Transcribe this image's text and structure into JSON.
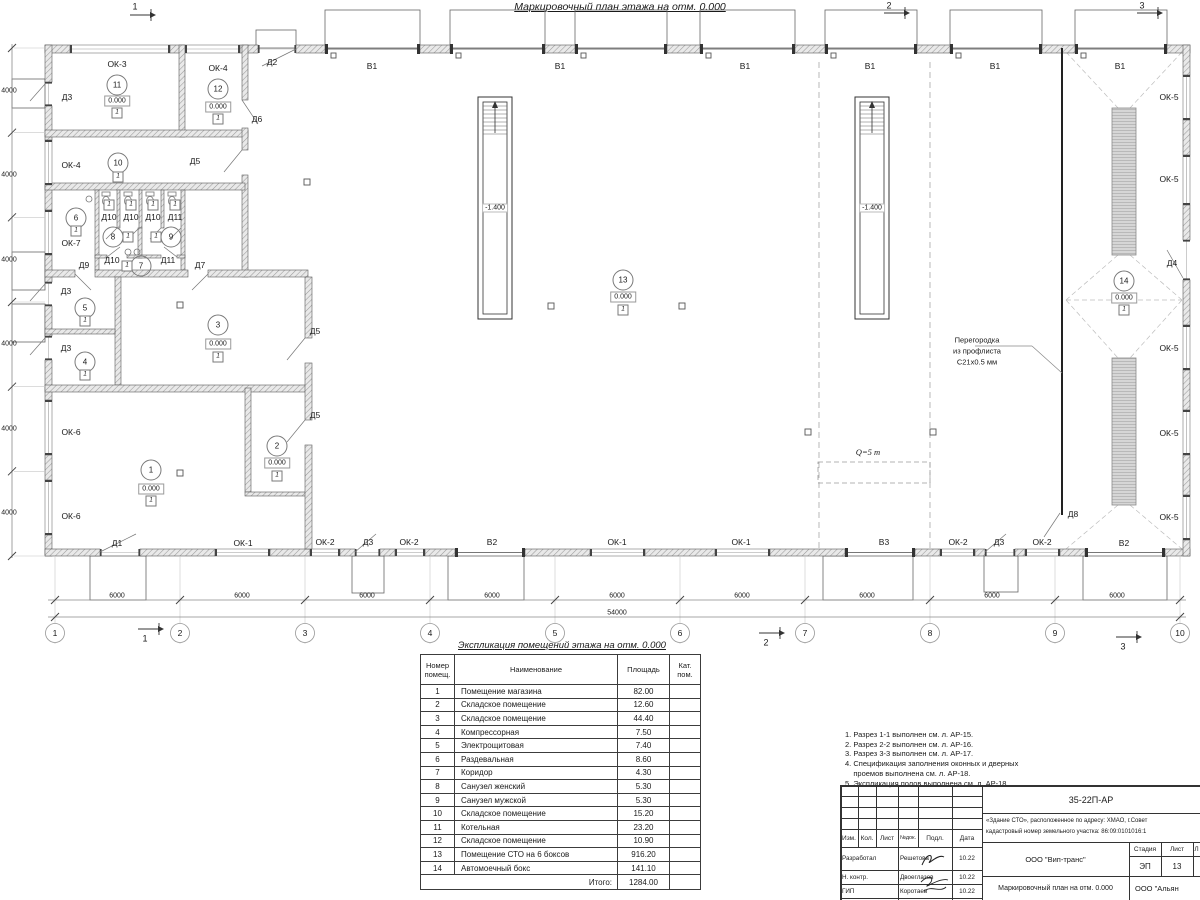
{
  "page_title": "Маркировочный план этажа на отм. 0.000",
  "plan": {
    "labels": [
      {
        "t": "Д2",
        "x": 272,
        "y": 62,
        "k": "w"
      },
      {
        "t": "В1",
        "x": 372,
        "y": 66,
        "k": "w"
      },
      {
        "t": "В1",
        "x": 560,
        "y": 66,
        "k": "w"
      },
      {
        "t": "В1",
        "x": 745,
        "y": 66,
        "k": "w"
      },
      {
        "t": "В1",
        "x": 870,
        "y": 66,
        "k": "w"
      },
      {
        "t": "В1",
        "x": 995,
        "y": 66,
        "k": "w"
      },
      {
        "t": "В1",
        "x": 1120,
        "y": 66,
        "k": "w"
      },
      {
        "t": "ОК-3",
        "x": 117,
        "y": 64,
        "k": "w"
      },
      {
        "t": "ОК-4",
        "x": 218,
        "y": 68,
        "k": "w"
      },
      {
        "t": "Д3",
        "x": 67,
        "y": 97,
        "k": "w"
      },
      {
        "t": "Д6",
        "x": 257,
        "y": 119,
        "k": "w"
      },
      {
        "t": "ОК-4",
        "x": 71,
        "y": 165,
        "k": "w"
      },
      {
        "t": "Д5",
        "x": 195,
        "y": 161,
        "k": "w"
      },
      {
        "t": "Д10",
        "x": 109,
        "y": 217,
        "k": "w"
      },
      {
        "t": "Д10",
        "x": 131,
        "y": 217,
        "k": "w"
      },
      {
        "t": "Д10",
        "x": 153,
        "y": 217,
        "k": "w"
      },
      {
        "t": "Д11",
        "x": 175,
        "y": 217,
        "k": "w"
      },
      {
        "t": "ОК-7",
        "x": 71,
        "y": 243,
        "k": "w"
      },
      {
        "t": "Д9",
        "x": 84,
        "y": 265,
        "k": "w"
      },
      {
        "t": "Д10",
        "x": 112,
        "y": 260,
        "k": "w"
      },
      {
        "t": "Д11",
        "x": 168,
        "y": 260,
        "k": "w"
      },
      {
        "t": "Д7",
        "x": 200,
        "y": 265,
        "k": "w"
      },
      {
        "t": "Д3",
        "x": 66,
        "y": 291,
        "k": "w"
      },
      {
        "t": "Д3",
        "x": 66,
        "y": 348,
        "k": "w"
      },
      {
        "t": "Д5",
        "x": 315,
        "y": 331,
        "k": "w"
      },
      {
        "t": "Д5",
        "x": 315,
        "y": 415,
        "k": "w"
      },
      {
        "t": "ОК-6",
        "x": 71,
        "y": 432,
        "k": "w"
      },
      {
        "t": "ОК-6",
        "x": 71,
        "y": 516,
        "k": "w"
      },
      {
        "t": "Д1",
        "x": 117,
        "y": 543,
        "k": "w"
      },
      {
        "t": "ОК-1",
        "x": 243,
        "y": 543,
        "k": "w"
      },
      {
        "t": "ОК-2",
        "x": 325,
        "y": 542,
        "k": "w"
      },
      {
        "t": "Д3",
        "x": 368,
        "y": 542,
        "k": "w"
      },
      {
        "t": "ОК-2",
        "x": 409,
        "y": 542,
        "k": "w"
      },
      {
        "t": "В2",
        "x": 492,
        "y": 542,
        "k": "w"
      },
      {
        "t": "ОК-1",
        "x": 617,
        "y": 542,
        "k": "w"
      },
      {
        "t": "ОК-1",
        "x": 741,
        "y": 542,
        "k": "w"
      },
      {
        "t": "В3",
        "x": 884,
        "y": 542,
        "k": "w"
      },
      {
        "t": "ОК-2",
        "x": 958,
        "y": 542,
        "k": "w"
      },
      {
        "t": "Д3",
        "x": 999,
        "y": 542,
        "k": "w"
      },
      {
        "t": "ОК-2",
        "x": 1042,
        "y": 542,
        "k": "w"
      },
      {
        "t": "В2",
        "x": 1124,
        "y": 543,
        "k": "w"
      },
      {
        "t": "ОК-5",
        "x": 1169,
        "y": 97,
        "k": "w"
      },
      {
        "t": "ОК-5",
        "x": 1169,
        "y": 179,
        "k": "w"
      },
      {
        "t": "Д4",
        "x": 1172,
        "y": 263,
        "k": "w"
      },
      {
        "t": "ОК-5",
        "x": 1169,
        "y": 348,
        "k": "w"
      },
      {
        "t": "ОК-5",
        "x": 1169,
        "y": 433,
        "k": "w"
      },
      {
        "t": "ОК-5",
        "x": 1169,
        "y": 517,
        "k": "w"
      },
      {
        "t": "Д8",
        "x": 1073,
        "y": 514,
        "k": "w"
      },
      {
        "t": "11",
        "x": 117,
        "y": 85,
        "k": "r"
      },
      {
        "t": "12",
        "x": 218,
        "y": 89,
        "k": "r"
      },
      {
        "t": "10",
        "x": 118,
        "y": 163,
        "k": "r"
      },
      {
        "t": "6",
        "x": 76,
        "y": 218,
        "k": "r"
      },
      {
        "t": "8",
        "x": 113,
        "y": 237,
        "k": "r"
      },
      {
        "t": "9",
        "x": 171,
        "y": 237,
        "k": "r"
      },
      {
        "t": "7",
        "x": 141,
        "y": 266,
        "k": "r"
      },
      {
        "t": "5",
        "x": 85,
        "y": 308,
        "k": "r"
      },
      {
        "t": "4",
        "x": 85,
        "y": 362,
        "k": "r"
      },
      {
        "t": "3",
        "x": 218,
        "y": 325,
        "k": "r"
      },
      {
        "t": "2",
        "x": 277,
        "y": 446,
        "k": "r"
      },
      {
        "t": "1",
        "x": 151,
        "y": 470,
        "k": "r"
      },
      {
        "t": "13",
        "x": 623,
        "y": 280,
        "k": "r"
      },
      {
        "t": "14",
        "x": 1124,
        "y": 281,
        "k": "r"
      },
      {
        "t": "0.000",
        "x": 117,
        "y": 101,
        "k": "e"
      },
      {
        "t": "0.000",
        "x": 218,
        "y": 107,
        "k": "e"
      },
      {
        "t": "0.000",
        "x": 218,
        "y": 344,
        "k": "e"
      },
      {
        "t": "0.000",
        "x": 277,
        "y": 463,
        "k": "e"
      },
      {
        "t": "0.000",
        "x": 151,
        "y": 489,
        "k": "e"
      },
      {
        "t": "0.000",
        "x": 623,
        "y": 297,
        "k": "e"
      },
      {
        "t": "0.000",
        "x": 1124,
        "y": 298,
        "k": "e"
      },
      {
        "t": "1",
        "x": 117,
        "y": 113,
        "k": "f"
      },
      {
        "t": "1",
        "x": 218,
        "y": 119,
        "k": "f"
      },
      {
        "t": "1",
        "x": 118,
        "y": 177,
        "k": "f"
      },
      {
        "t": "1",
        "x": 76,
        "y": 231,
        "k": "f"
      },
      {
        "t": "1",
        "x": 128,
        "y": 237,
        "k": "f"
      },
      {
        "t": "1",
        "x": 156,
        "y": 237,
        "k": "f"
      },
      {
        "t": "1",
        "x": 127,
        "y": 266,
        "k": "f"
      },
      {
        "t": "1",
        "x": 85,
        "y": 321,
        "k": "f"
      },
      {
        "t": "1",
        "x": 85,
        "y": 375,
        "k": "f"
      },
      {
        "t": "1",
        "x": 218,
        "y": 357,
        "k": "f"
      },
      {
        "t": "1",
        "x": 277,
        "y": 476,
        "k": "f"
      },
      {
        "t": "1",
        "x": 151,
        "y": 501,
        "k": "f"
      },
      {
        "t": "1",
        "x": 623,
        "y": 310,
        "k": "f"
      },
      {
        "t": "1",
        "x": 1124,
        "y": 310,
        "k": "f"
      },
      {
        "t": "1",
        "x": 109,
        "y": 205,
        "k": "f"
      },
      {
        "t": "1",
        "x": 131,
        "y": 205,
        "k": "f"
      },
      {
        "t": "1",
        "x": 153,
        "y": 205,
        "k": "f"
      },
      {
        "t": "1",
        "x": 175,
        "y": 205,
        "k": "f"
      },
      {
        "t": "1",
        "x": 55,
        "y": 633,
        "k": "g"
      },
      {
        "t": "2",
        "x": 180,
        "y": 633,
        "k": "g"
      },
      {
        "t": "3",
        "x": 305,
        "y": 633,
        "k": "g"
      },
      {
        "t": "4",
        "x": 430,
        "y": 633,
        "k": "g"
      },
      {
        "t": "5",
        "x": 555,
        "y": 633,
        "k": "g"
      },
      {
        "t": "6",
        "x": 680,
        "y": 633,
        "k": "g"
      },
      {
        "t": "7",
        "x": 805,
        "y": 633,
        "k": "g"
      },
      {
        "t": "8",
        "x": 930,
        "y": 633,
        "k": "g"
      },
      {
        "t": "9",
        "x": 1055,
        "y": 633,
        "k": "g"
      },
      {
        "t": "10",
        "x": 1180,
        "y": 633,
        "k": "g"
      },
      {
        "t": "6000",
        "x": 117,
        "y": 596,
        "k": "d"
      },
      {
        "t": "6000",
        "x": 242,
        "y": 596,
        "k": "d"
      },
      {
        "t": "6000",
        "x": 367,
        "y": 596,
        "k": "d"
      },
      {
        "t": "6000",
        "x": 492,
        "y": 596,
        "k": "d"
      },
      {
        "t": "6000",
        "x": 617,
        "y": 596,
        "k": "d"
      },
      {
        "t": "6000",
        "x": 742,
        "y": 596,
        "k": "d"
      },
      {
        "t": "6000",
        "x": 867,
        "y": 596,
        "k": "d"
      },
      {
        "t": "6000",
        "x": 992,
        "y": 596,
        "k": "d"
      },
      {
        "t": "6000",
        "x": 1117,
        "y": 596,
        "k": "d"
      },
      {
        "t": "54000",
        "x": 617,
        "y": 613,
        "k": "d"
      },
      {
        "t": "4000",
        "x": 9,
        "y": 91,
        "k": "dv"
      },
      {
        "t": "4000",
        "x": 9,
        "y": 175,
        "k": "dv"
      },
      {
        "t": "4000",
        "x": 9,
        "y": 260,
        "k": "dv"
      },
      {
        "t": "4000",
        "x": 9,
        "y": 344,
        "k": "dv"
      },
      {
        "t": "4000",
        "x": 9,
        "y": 429,
        "k": "dv"
      },
      {
        "t": "4000",
        "x": 9,
        "y": 513,
        "k": "dv"
      },
      {
        "t": "-1.400",
        "x": 495,
        "y": 208,
        "k": "pv"
      },
      {
        "t": "-1.400",
        "x": 872,
        "y": 208,
        "k": "pv"
      },
      {
        "t": "1",
        "x": 135,
        "y": 7,
        "k": "s"
      },
      {
        "t": "2",
        "x": 889,
        "y": 6,
        "k": "s"
      },
      {
        "t": "3",
        "x": 1142,
        "y": 6,
        "k": "s"
      },
      {
        "t": "1",
        "x": 145,
        "y": 639,
        "k": "s"
      },
      {
        "t": "2",
        "x": 766,
        "y": 643,
        "k": "s"
      },
      {
        "t": "3",
        "x": 1123,
        "y": 647,
        "k": "s"
      },
      {
        "t": "Перегородка",
        "x": 977,
        "y": 340,
        "k": "a"
      },
      {
        "t": "из профлиста",
        "x": 977,
        "y": 351,
        "k": "a"
      },
      {
        "t": "С21х0.5 мм",
        "x": 977,
        "y": 362,
        "k": "a"
      },
      {
        "t": "Q=5 т",
        "x": 868,
        "y": 452,
        "k": "q"
      }
    ]
  },
  "schedule": {
    "title": "Экспликация помещений этажа на отм. 0.000",
    "col_num": "Номер\nпомещ.",
    "col_name": "Наименование",
    "col_area": "Площадь",
    "col_cat": "Кат.\nпом.",
    "rows": [
      [
        "1",
        "Помещение магазина",
        "82.00"
      ],
      [
        "2",
        "Складское помещение",
        "12.60"
      ],
      [
        "3",
        "Складское помещение",
        "44.40"
      ],
      [
        "4",
        "Компрессорная",
        "7.50"
      ],
      [
        "5",
        "Электрощитовая",
        "7.40"
      ],
      [
        "6",
        "Раздевальная",
        "8.60"
      ],
      [
        "7",
        "Коридор",
        "4.30"
      ],
      [
        "8",
        "Санузел женский",
        "5.30"
      ],
      [
        "9",
        "Санузел мужской",
        "5.30"
      ],
      [
        "10",
        "Складское помещение",
        "15.20"
      ],
      [
        "11",
        "Котельная",
        "23.20"
      ],
      [
        "12",
        "Складское помещение",
        "10.90"
      ],
      [
        "13",
        "Помещение СТО на 6 боксов",
        "916.20"
      ],
      [
        "14",
        "Автомоечный бокс",
        "141.10"
      ]
    ],
    "total_label": "Итого:",
    "total_value": "1284.00"
  },
  "notes": {
    "lines": [
      "1. Разрез 1-1 выполнен см. л. АР-15.",
      "2. Разрез 2-2 выполнен см. л. АР-16.",
      "3. Разрез 3-3 выполнен см. л. АР-17.",
      "4. Спецификация заполнения оконных и дверных",
      "    проемов выполнена см. л. АР-18.",
      "5. Экспликация полов выполнена см. л. АР-18."
    ]
  },
  "titleblock": {
    "doc_number": "35-22П-АР",
    "project_line1": "«Здание СТО», расположенное по адресу: ХМАО, г.Совет",
    "project_line2": "кадастровый номер земельного участка: 86:09:0101016:1",
    "header_cols": [
      "Изм.",
      "Кол.",
      "Лист",
      "№док.",
      "Подл.",
      "Дата"
    ],
    "sign_rows": [
      [
        "Разработал",
        "Решетова",
        "10.22"
      ],
      [
        "Н. контр.",
        "Двоеглазов",
        "10.22"
      ],
      [
        "ГИП",
        "Коротаев",
        "10.22"
      ]
    ],
    "org": "ООО \"Вип-транс\"",
    "stage_label": "Стадия",
    "stage_value": "ЭП",
    "sheet_label": "Лист",
    "sheet_value": "13",
    "sheets_label": "Л",
    "drawing_title": "Маркировочный план на отм. 0.000",
    "org2": "ООО \"Альян"
  }
}
